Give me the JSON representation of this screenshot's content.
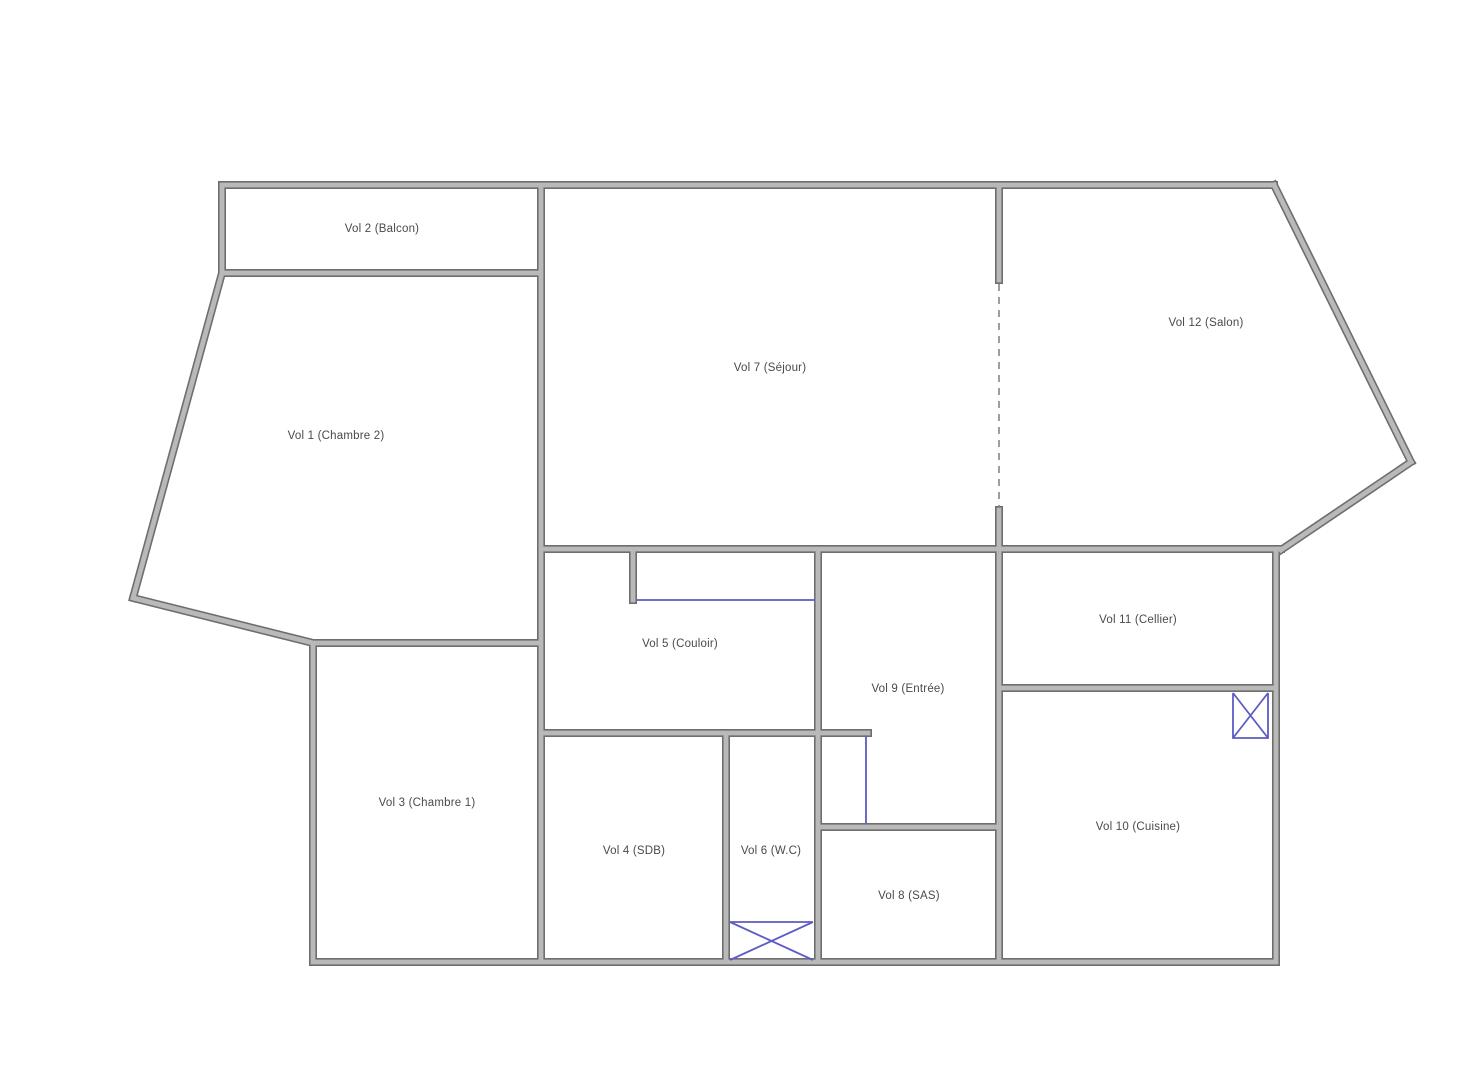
{
  "plan_title": "Floor plan",
  "colors": {
    "wall_edge": "#6e6e6e",
    "wall_fill": "#b9b9b9",
    "door_blue": "#5c5cc4",
    "dash_gray": "#858585",
    "label_text": "#4a4a4a",
    "background": "#ffffff"
  },
  "rooms": [
    {
      "id": "vol1",
      "label": "Vol 1 (Chambre 2)",
      "x": 336,
      "y": 436
    },
    {
      "id": "vol2",
      "label": "Vol 2 (Balcon)",
      "x": 382,
      "y": 229
    },
    {
      "id": "vol3",
      "label": "Vol 3 (Chambre 1)",
      "x": 427,
      "y": 803
    },
    {
      "id": "vol4",
      "label": "Vol 4 (SDB)",
      "x": 634,
      "y": 851
    },
    {
      "id": "vol5",
      "label": "Vol 5 (Couloir)",
      "x": 680,
      "y": 644
    },
    {
      "id": "vol6",
      "label": "Vol 6 (W.C)",
      "x": 771,
      "y": 851
    },
    {
      "id": "vol7",
      "label": "Vol 7 (Séjour)",
      "x": 770,
      "y": 368
    },
    {
      "id": "vol8",
      "label": "Vol 8 (SAS)",
      "x": 909,
      "y": 896
    },
    {
      "id": "vol9",
      "label": "Vol 9 (Entrée)",
      "x": 908,
      "y": 689
    },
    {
      "id": "vol10",
      "label": "Vol 10 (Cuisine)",
      "x": 1138,
      "y": 827
    },
    {
      "id": "vol11",
      "label": "Vol 11 (Cellier)",
      "x": 1138,
      "y": 620
    },
    {
      "id": "vol12",
      "label": "Vol 12 (Salon)",
      "x": 1206,
      "y": 323
    }
  ],
  "annotations": {
    "dashed_partition": "sejour-salon-dashed-partition",
    "couloir_opening": "couloir-opening-line",
    "entree_closet_opening": "entree-closet-opening-line",
    "wc_fixture": "wc-fixture-x-box",
    "cuisine_fixture": "cuisine-fixture-x-box"
  }
}
